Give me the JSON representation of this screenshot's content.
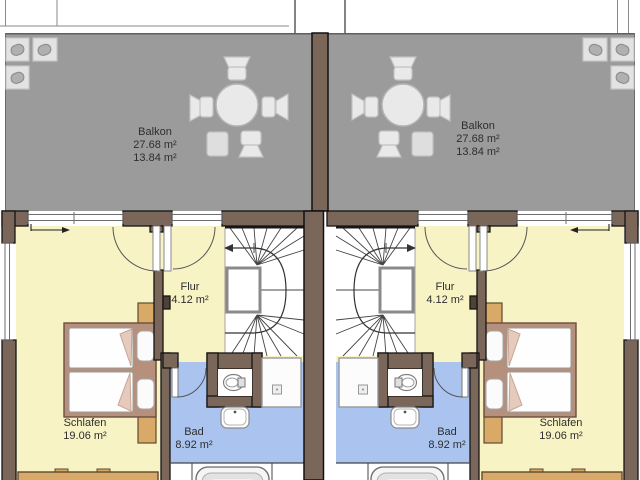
{
  "units": [
    {
      "side": "left",
      "balkon": {
        "label": "Balkon",
        "area_total": "27.68 m²",
        "area_half": "13.84 m²"
      },
      "flur": {
        "label": "Flur",
        "area": "4.12 m²"
      },
      "schlafen": {
        "label": "Schlafen",
        "area": "19.06 m²"
      },
      "bad": {
        "label": "Bad",
        "area": "8.92 m²"
      }
    },
    {
      "side": "right",
      "balkon": {
        "label": "Balkon",
        "area_total": "27.68 m²",
        "area_half": "13.84 m²"
      },
      "flur": {
        "label": "Flur",
        "area": "4.12 m²"
      },
      "schlafen": {
        "label": "Schlafen",
        "area": "19.06 m²"
      },
      "bad": {
        "label": "Bad",
        "area": "8.92 m²"
      }
    }
  ],
  "colors": {
    "balcony_floor": "#9b9b9b",
    "wall_brown": "#7b675a",
    "wall_dark": "#4e4138",
    "room_yellow": "#f8f3c5",
    "bath_blue": "#abc4ef",
    "furniture_tan": "#d8a967",
    "bed_frame": "#b5917d",
    "bed_blanket": "#e6cbbc",
    "stair_floor": "#ffffff",
    "furniture_gray": "#e9e9e9"
  }
}
